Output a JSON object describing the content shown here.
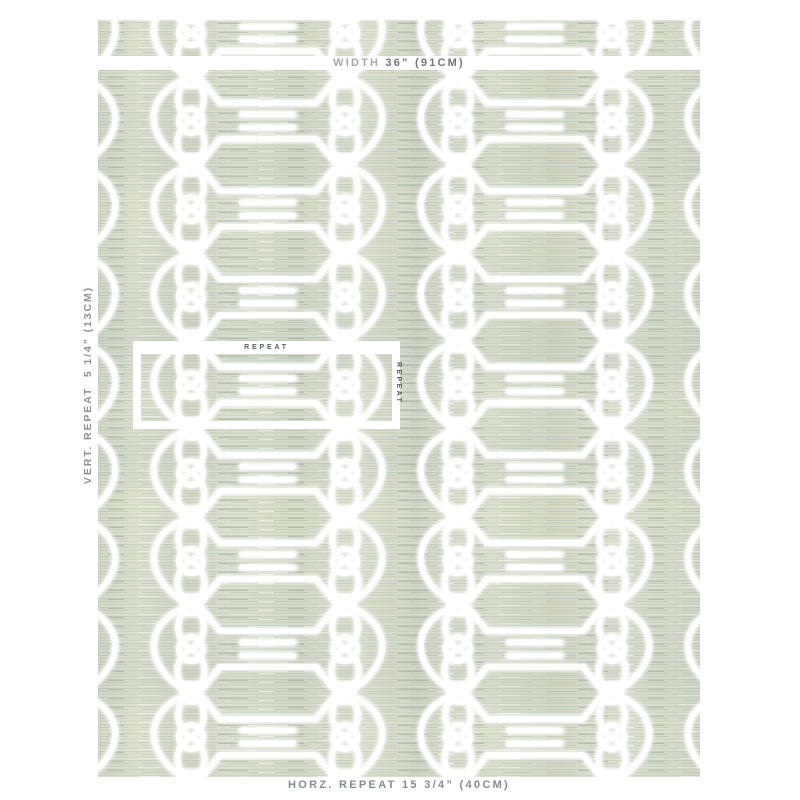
{
  "page": {
    "background_color": "#ffffff"
  },
  "swatch": {
    "fabric_base_color": "#d7ddc9",
    "embroidery_color": "#ffffff"
  },
  "annotations": {
    "width_label": "WIDTH ",
    "width_value": "36” (91CM)",
    "vertical_repeat": "VERT. REPEAT  5 1/4” (13CM)",
    "horizontal_repeat": "HORZ. REPEAT 15 3/4” (40CM)",
    "repeat_frame_top_label": "REPEAT",
    "repeat_frame_side_label": "REPEAT",
    "text_color": "#8b9192",
    "width_label_color": "#a4aaa8",
    "width_value_color": "#707678",
    "frame_label_color": "#565d5f"
  }
}
